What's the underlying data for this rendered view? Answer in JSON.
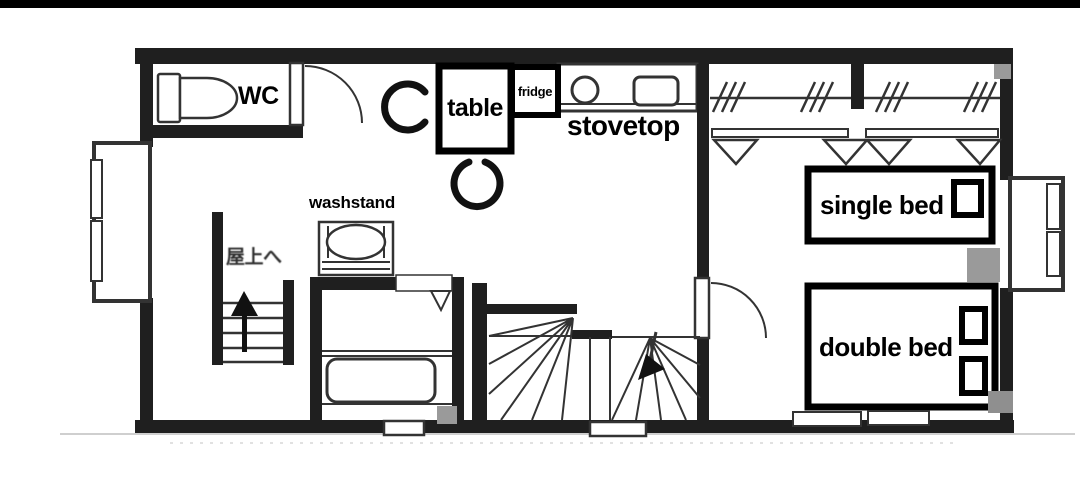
{
  "page": {
    "kind": "scanned floor plan photo",
    "letterbox_color": "#000000",
    "background_color": "#ffffff"
  },
  "labels": {
    "wc": "WC",
    "table": "table",
    "fridge": "fridge",
    "stovetop": "stovetop",
    "washstand": "washstand",
    "to_rooftop": "屋上へ",
    "single_bed": "single bed",
    "double_bed": "double bed"
  },
  "colors": {
    "wall": "#1f1f1f",
    "line": "#333333",
    "gray_marker": "#9a9a9a",
    "label_text": "#000000",
    "label_box_border": "#000000",
    "label_box_fill": "#ffffff"
  },
  "icons": {
    "toilet-icon": "tank + bowl outline",
    "door-swing-icon": "quarter-circle arc with leaf",
    "chair-icon": "thick open C arc",
    "sink-burner-icon": "circle on counter",
    "stove-icon": "rounded rectangle on counter",
    "hanger-rail-icon": "rail with triple slash marks",
    "folding-door-icon": "downward V triangles",
    "bay-window-icon": "protruding sashed window",
    "winder-stair-icon": "fanned radiating treads with down arrow",
    "roof-stair-icon": "rails with treads and up arrow",
    "bathtub-icon": "rounded rectangle tub",
    "pillow-icon": "small outlined square on bed",
    "gray-square-marker": "solid gray square"
  },
  "marker_counts": {
    "gray_squares": 4,
    "closet_hatch_groups": 4,
    "folding_door_triangles": 4
  }
}
